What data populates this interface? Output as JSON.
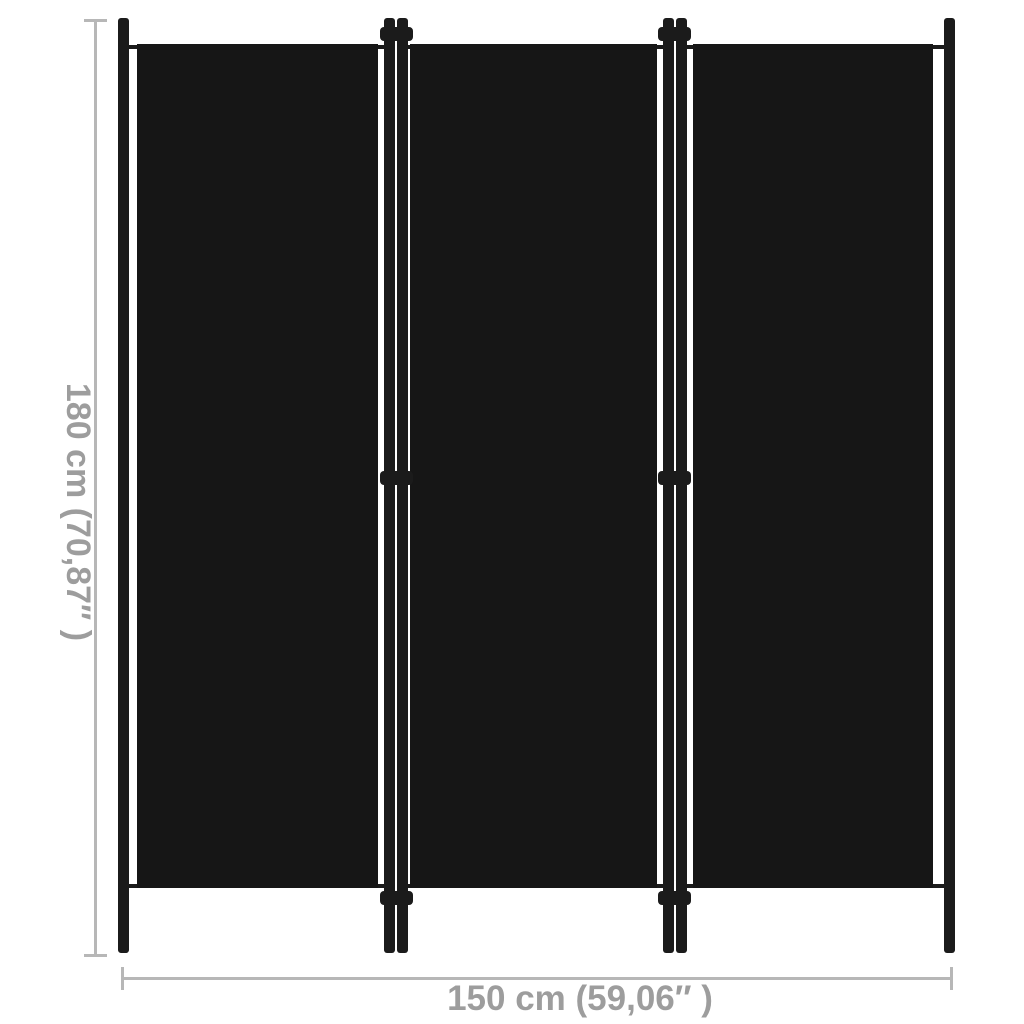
{
  "page": {
    "type": "product-dimension-diagram"
  },
  "product": {
    "panel_count": 3,
    "hinge_junctions": 2
  },
  "dimensions": {
    "height_label": "180 cm (70,87″ )",
    "width_label": "150 cm (59,06″ )"
  },
  "theme": {
    "bg-color": "#ffffff",
    "fabric-color": "#161616",
    "frame-color": "#1b1b1b",
    "dim-line-color": "#b7b7b7",
    "dim-text-color": "#9d9d9d"
  }
}
